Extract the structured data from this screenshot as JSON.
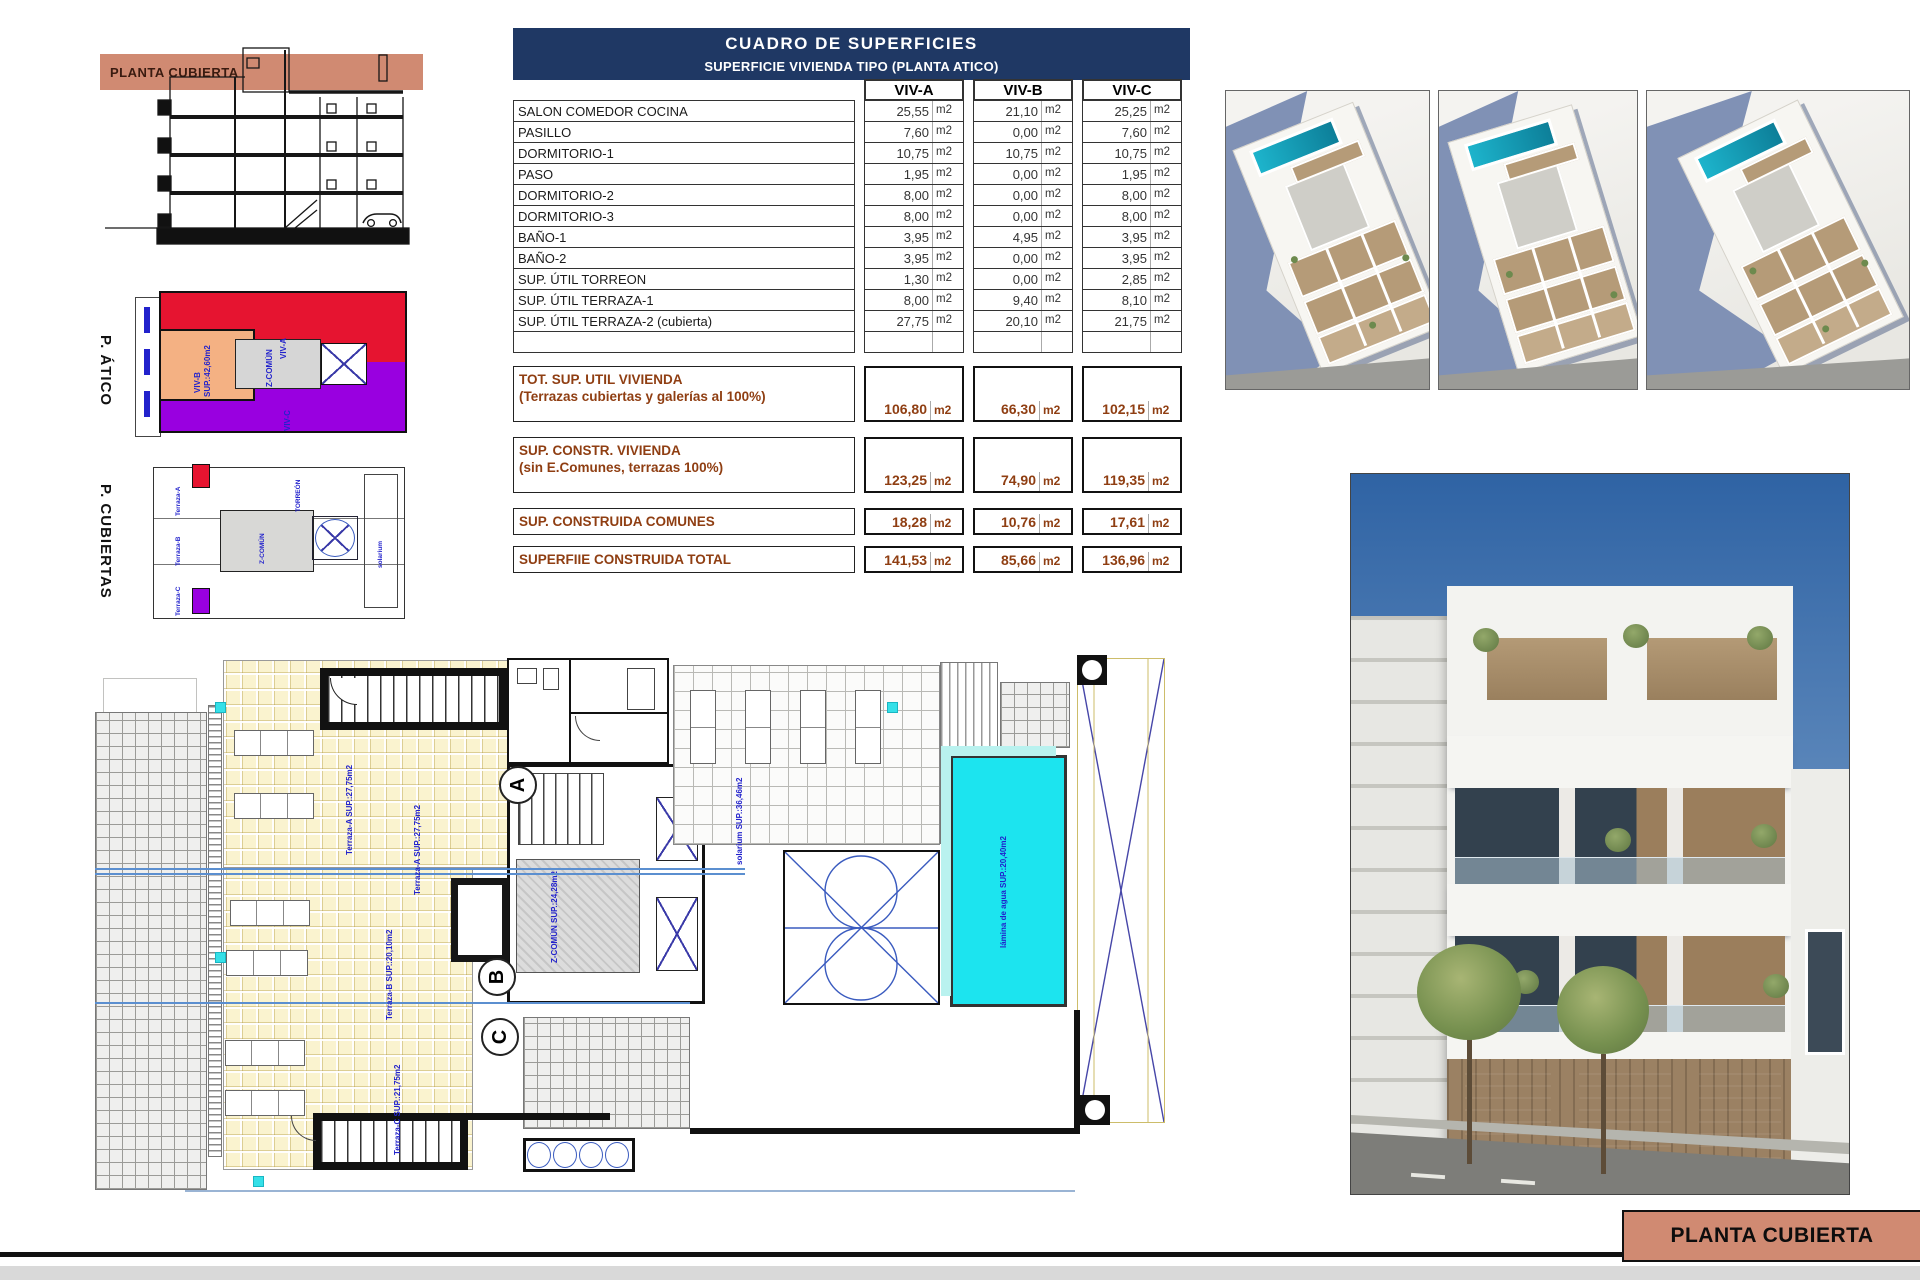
{
  "colors": {
    "navy": "#1f3864",
    "salmon": "#d08a72",
    "brown": "#8f3e12",
    "pool_cyan": "#1ce4ef",
    "red": "#e61430",
    "purple": "#9900e0",
    "orange": "#f4b183",
    "cad_blue": "#2222cc"
  },
  "section_view": {
    "band_label": "PLANTA CUBIERTA"
  },
  "atico": {
    "side_label": "P. ÁTICO",
    "viv_a": "VIV-A",
    "viv_b": "VIV-B",
    "viv_b_sup": "SUP.:42,60m2",
    "viv_c": "VIV-C",
    "zcomun": "Z-COMÚN"
  },
  "cubiertas": {
    "side_label": "P. CUBIERTAS",
    "labels": {
      "a": "Terraza-A",
      "b": "Terraza-B",
      "c": "Terraza-C",
      "z": "Z-COMÚN",
      "t": "TORREÓN",
      "s": "solarium"
    }
  },
  "table": {
    "title": "CUADRO DE SUPERFICIES",
    "subtitle": "SUPERFICIE VIVIENDA TIPO  (PLANTA ATICO)",
    "columns": [
      "VIV-A",
      "VIV-B",
      "VIV-C"
    ],
    "unit": "m2",
    "rows": [
      {
        "label": "SALON COMEDOR COCINA",
        "a": "25,55",
        "b": "21,10",
        "c": "25,25"
      },
      {
        "label": "PASILLO",
        "a": "7,60",
        "b": "0,00",
        "c": "7,60"
      },
      {
        "label": "DORMITORIO-1",
        "a": "10,75",
        "b": "10,75",
        "c": "10,75"
      },
      {
        "label": "PASO",
        "a": "1,95",
        "b": "0,00",
        "c": "1,95"
      },
      {
        "label": "DORMITORIO-2",
        "a": "8,00",
        "b": "0,00",
        "c": "8,00"
      },
      {
        "label": "DORMITORIO-3",
        "a": "8,00",
        "b": "0,00",
        "c": "8,00"
      },
      {
        "label": "BAÑO-1",
        "a": "3,95",
        "b": "4,95",
        "c": "3,95"
      },
      {
        "label": "BAÑO-2",
        "a": "3,95",
        "b": "0,00",
        "c": "3,95"
      },
      {
        "label": "SUP. ÚTIL TORREON",
        "a": "1,30",
        "b": "0,00",
        "c": "2,85"
      },
      {
        "label": "SUP. ÚTIL TERRAZA-1",
        "a": "8,00",
        "b": "9,40",
        "c": "8,10"
      },
      {
        "label": "SUP. ÚTIL TERRAZA-2 (cubierta)",
        "a": "27,75",
        "b": "20,10",
        "c": "21,75"
      }
    ],
    "summary_rows": [
      {
        "l1": "TOT. SUP. UTIL VIVIENDA",
        "l2": "(Terrazas cubiertas y galerías al 100%)",
        "a": "106,80",
        "b": "66,30",
        "c": "102,15",
        "tall": true
      },
      {
        "l1": "SUP. CONSTR. VIVIENDA",
        "l2": "(sin E.Comunes, terrazas 100%)",
        "a": "123,25",
        "b": "74,90",
        "c": "119,35",
        "tall": true
      },
      {
        "l1": "SUP. CONSTRUIDA COMUNES",
        "l2": "",
        "a": "18,28",
        "b": "10,76",
        "c": "17,61",
        "tall": false
      },
      {
        "l1": "SUPERFIIE CONSTRUIDA TOTAL",
        "l2": "",
        "a": "141,53",
        "b": "85,66",
        "c": "136,96",
        "tall": false
      }
    ]
  },
  "plan": {
    "labels": {
      "terraza_a": "Terraza-A SUP.:27,75m2",
      "terraza_a2": "Terraza-A SUP.:27,75m2",
      "terraza_b": "Terraza-B SUP.:20,10m2",
      "terraza_c": "Terraza-C SUP.:21,75m2",
      "solarium": "solarium SUP.:36,46m2",
      "pool": "lámina de agua SUP.:20,40m2",
      "zcomun": "Z-COMÚN SUP.:24,28m2",
      "letter_a": "A",
      "letter_b": "B",
      "letter_c": "C"
    }
  },
  "sheet": {
    "bottom_label": "PLANTA CUBIERTA"
  }
}
